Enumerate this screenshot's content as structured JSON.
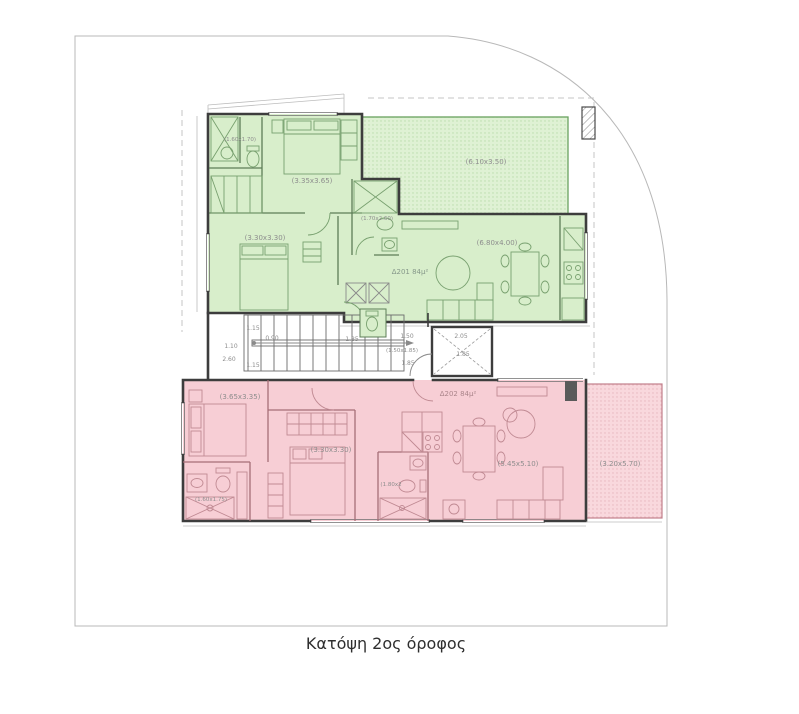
{
  "title_caption": "Κατόψη 2ος όροφος",
  "colors": {
    "green_fill": "#d8eecb",
    "green_terrace_fill": "#dff1d4",
    "green_line": "#5d7d57",
    "pink_fill": "#f7ced5",
    "pink_veranda_fill": "#f9d8dd",
    "pink_line": "#a66e77",
    "wall": "#3d3d3d",
    "dim_text": "#8d8d8d"
  },
  "apartment_a": {
    "id_label": "Δ201 84μ²",
    "rooms": {
      "bath_small": "(1.60x1.70)",
      "bedroom_master": "(3.35x3.65)",
      "bedroom_2": "(3.30x3.30)",
      "bath_main": "(1.70x2.60)",
      "living_kitchen": "(6.80x4.00)",
      "terrace": "(6.10x3.50)"
    }
  },
  "apartment_b": {
    "id_label": "Δ202 84μ²",
    "rooms": {
      "bedroom_master": "(3.65x3.35)",
      "bedroom_2": "(3.30x3.30)",
      "bath_small": "(1.60x1.75)",
      "bath_main": "(1.80x2",
      "living_kitchen": "(5.45x5.10)",
      "veranda": "(3.20x5.70)"
    }
  },
  "core": {
    "stair_width_top": "1.15",
    "stair_flight": "1.10",
    "stair_mid": "0.90",
    "stair_length": "2.60",
    "stair_width_bottom": "1.15",
    "wc_dim": "1.85",
    "lobby_width": "1.50",
    "lobby_size": "(1.50x1.85)",
    "lobby_depth": "1.85",
    "elevator_width": "2.05",
    "elevator_depth": "1.85"
  }
}
